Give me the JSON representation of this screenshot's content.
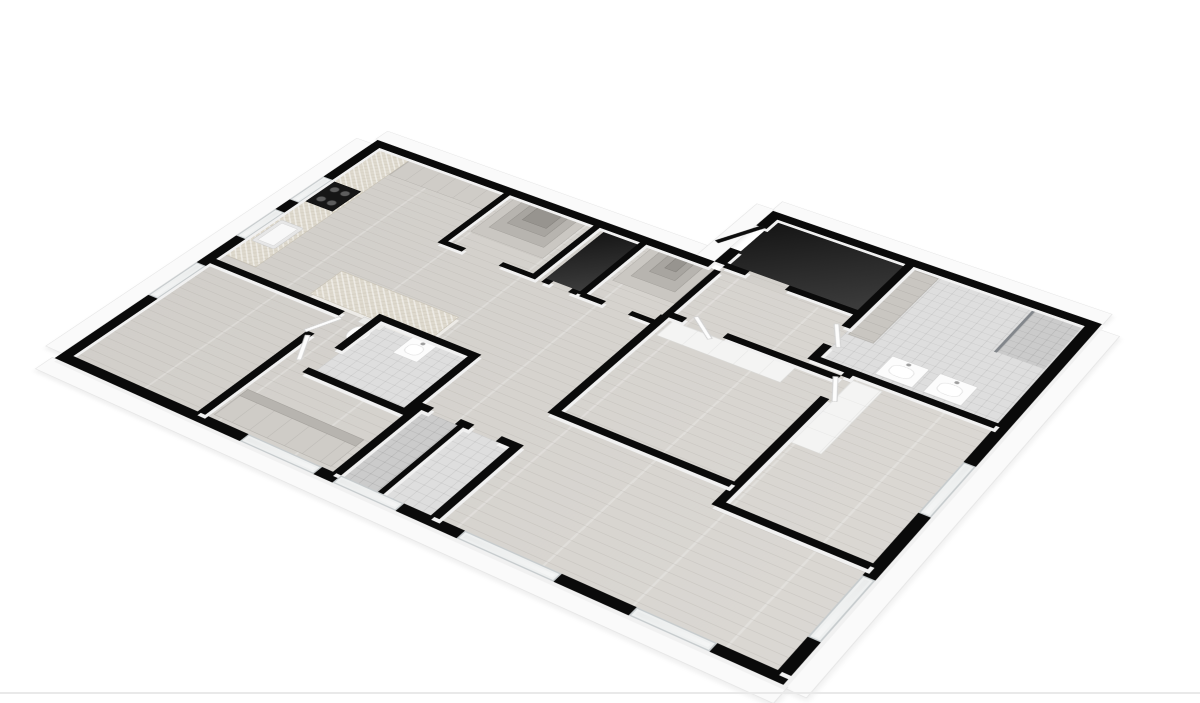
{
  "page": {
    "background": "#ffffff",
    "width": 1200,
    "height": 703
  },
  "palette": {
    "wall_cut_top": "#0a0a0a",
    "wall_face": "#f1f1f1",
    "slab_white": "#fafafa",
    "wood_floor": "#d8d5d0",
    "tile_floor": "#dedede",
    "dark_floor": "#262626",
    "cabinet_gray": "#cfccc7",
    "stone_counter": "#ded9cd",
    "shelf_gray": "#b7b4af",
    "footer_divider": "#e9e9e9"
  },
  "floorplan": {
    "rects": [
      {
        "n": "slab-west",
        "k": "fascia",
        "x": 2,
        "y": 192,
        "w": 28,
        "h": 616
      },
      {
        "n": "slab-north-kitchen",
        "k": "fascia",
        "x": 26,
        "y": 152,
        "w": 566,
        "h": 28
      },
      {
        "n": "slab-north-suite",
        "k": "fascia",
        "x": 588,
        "y": 2,
        "w": 484,
        "h": 28
      },
      {
        "n": "slab-west-suite",
        "k": "fascia",
        "x": 562,
        "y": 26,
        "w": 28,
        "h": 158
      },
      {
        "n": "slab-east",
        "k": "fascia",
        "x": 1070,
        "y": 42,
        "w": 30,
        "h": 782
      },
      {
        "n": "slab-south",
        "k": "fascia",
        "x": 26,
        "y": 820,
        "w": 1050,
        "h": 30
      },
      {
        "n": "floor-great-room",
        "k": "wood",
        "x": 46,
        "y": 196,
        "w": 1008,
        "h": 608
      },
      {
        "n": "floor-suite-wing",
        "k": "wood",
        "x": 606,
        "y": 46,
        "w": 448,
        "h": 150
      },
      {
        "n": "floor-entry-vestibule",
        "k": "dark",
        "x": 606,
        "y": 46,
        "w": 194,
        "h": 128
      },
      {
        "n": "floor-linen-closet",
        "k": "dark",
        "x": 430,
        "y": 196,
        "w": 54,
        "h": 140
      },
      {
        "n": "floor-main-bathroom",
        "k": "tile",
        "x": 812,
        "y": 46,
        "w": 242,
        "h": 244
      },
      {
        "n": "floor-shower-nook",
        "k": "tile2",
        "x": 988,
        "y": 48,
        "w": 64,
        "h": 110
      },
      {
        "n": "floor-center-bathroom",
        "k": "tile",
        "x": 314,
        "y": 532,
        "w": 136,
        "h": 128
      },
      {
        "n": "floor-shower-room-a",
        "k": "tile2",
        "x": 470,
        "y": 652,
        "w": 54,
        "h": 152
      },
      {
        "n": "floor-shower-room-b",
        "k": "tile",
        "x": 532,
        "y": 652,
        "w": 68,
        "h": 152
      },
      {
        "n": "kitchen-counter",
        "k": "stone",
        "x": 46,
        "y": 196,
        "w": 56,
        "h": 330
      },
      {
        "n": "kitchen-sink",
        "k": "sink",
        "x": 54,
        "y": 418,
        "w": 40,
        "h": 62
      },
      {
        "n": "cooktop",
        "k": "appliance",
        "x": 50,
        "y": 302,
        "w": 48,
        "h": 62
      },
      {
        "n": "kitchen-tall-cabinets",
        "k": "cabinet",
        "x": 102,
        "y": 196,
        "w": 170,
        "h": 50
      },
      {
        "n": "kitchen-island",
        "k": "island",
        "x": 200,
        "y": 470,
        "w": 190,
        "h": 64
      },
      {
        "n": "pantry-shelf-outer",
        "k": "shelf1",
        "x": 282,
        "y": 196,
        "w": 118,
        "h": 104
      },
      {
        "n": "pantry-shelf-mid",
        "k": "shelf2",
        "x": 296,
        "y": 196,
        "w": 90,
        "h": 82
      },
      {
        "n": "pantry-shelf-inner",
        "k": "shelf3",
        "x": 310,
        "y": 196,
        "w": 62,
        "h": 60
      },
      {
        "n": "pantry-shelf-core",
        "k": "shelf4",
        "x": 322,
        "y": 196,
        "w": 40,
        "h": 42
      },
      {
        "n": "walkin-closet-shelf-outer",
        "k": "shelf1",
        "x": 504,
        "y": 196,
        "w": 96,
        "h": 96
      },
      {
        "n": "walkin-closet-shelf-mid",
        "k": "shelf2",
        "x": 518,
        "y": 196,
        "w": 68,
        "h": 74
      },
      {
        "n": "walkin-closet-shelf-inner",
        "k": "shelf3",
        "x": 532,
        "y": 196,
        "w": 40,
        "h": 52
      },
      {
        "n": "walkin-closet-shelf-core",
        "k": "shelf4",
        "x": 544,
        "y": 196,
        "w": 18,
        "h": 34
      },
      {
        "n": "bathroom-wardrobe",
        "k": "cabinet-v",
        "x": 816,
        "y": 52,
        "w": 36,
        "h": 176
      },
      {
        "n": "vanity-basin-1",
        "k": "vanity",
        "x": 884,
        "y": 238,
        "w": 52,
        "h": 46
      },
      {
        "n": "vanity-basin-2",
        "k": "vanity",
        "x": 950,
        "y": 238,
        "w": 52,
        "h": 46
      },
      {
        "n": "shower-glass",
        "k": "glass",
        "x": 984,
        "y": 48,
        "w": 4,
        "h": 112
      },
      {
        "n": "toilet-tank",
        "k": "fixture",
        "x": 290,
        "y": 536,
        "w": 36,
        "h": 14
      },
      {
        "n": "toilet-bowl",
        "k": "toilet",
        "x": 294,
        "y": 552,
        "w": 28,
        "h": 36
      },
      {
        "n": "centerbath-vanity",
        "k": "vanity",
        "x": 368,
        "y": 536,
        "w": 38,
        "h": 42
      },
      {
        "n": "bedroom1-closet",
        "k": "closet",
        "x": 868,
        "y": 310,
        "w": 42,
        "h": 150
      },
      {
        "n": "bedroom2-closet",
        "k": "closet",
        "x": 618,
        "y": 326,
        "w": 180,
        "h": 38
      },
      {
        "n": "wardrobe-shelving",
        "k": "cabinet",
        "x": 270,
        "y": 736,
        "w": 180,
        "h": 62
      },
      {
        "n": "wardrobe-shelf-band",
        "k": "shelf2",
        "x": 270,
        "y": 736,
        "w": 180,
        "h": 16
      },
      {
        "n": "wall-north",
        "k": "wall",
        "x": 30,
        "y": 180,
        "w": 560,
        "h": 16
      },
      {
        "n": "wall-suite-north",
        "k": "wall",
        "x": 590,
        "y": 30,
        "w": 480,
        "h": 16
      },
      {
        "n": "wall-suite-west-a",
        "k": "wall",
        "x": 590,
        "y": 46,
        "w": 16,
        "h": 28
      },
      {
        "n": "wall-suite-west-b",
        "k": "wall",
        "x": 590,
        "y": 140,
        "w": 16,
        "h": 40
      },
      {
        "n": "wall-west",
        "k": "wall",
        "x": 30,
        "y": 196,
        "w": 16,
        "h": 608
      },
      {
        "n": "wall-south",
        "k": "wall",
        "x": 30,
        "y": 804,
        "w": 1040,
        "h": 16
      },
      {
        "n": "wall-east",
        "k": "wall",
        "x": 1054,
        "y": 46,
        "w": 16,
        "h": 758
      },
      {
        "n": "wall-vestibule-a",
        "k": "wall",
        "x": 606,
        "y": 174,
        "w": 34,
        "h": 12
      },
      {
        "n": "wall-vestibule-b",
        "k": "wall",
        "x": 700,
        "y": 174,
        "w": 106,
        "h": 12
      },
      {
        "n": "wall-pantry-west",
        "k": "wall",
        "x": 262,
        "y": 196,
        "w": 10,
        "h": 150
      },
      {
        "n": "wall-pantry-east",
        "k": "wall",
        "x": 410,
        "y": 196,
        "w": 10,
        "h": 150
      },
      {
        "n": "wall-pantry-south-a",
        "k": "wall",
        "x": 262,
        "y": 336,
        "w": 40,
        "h": 10
      },
      {
        "n": "wall-pantry-south-b",
        "k": "wall",
        "x": 362,
        "y": 336,
        "w": 58,
        "h": 10
      },
      {
        "n": "wall-linen-east",
        "k": "wall",
        "x": 484,
        "y": 196,
        "w": 10,
        "h": 150
      },
      {
        "n": "wall-linen-south-a",
        "k": "wall",
        "x": 430,
        "y": 336,
        "w": 12,
        "h": 10
      },
      {
        "n": "wall-linen-south-b",
        "k": "wall",
        "x": 472,
        "y": 336,
        "w": 12,
        "h": 10
      },
      {
        "n": "wall-closet-east",
        "k": "wall",
        "x": 600,
        "y": 196,
        "w": 10,
        "h": 150
      },
      {
        "n": "wall-closet-south-a",
        "k": "wall",
        "x": 494,
        "y": 336,
        "w": 30,
        "h": 10
      },
      {
        "n": "wall-closet-south-b",
        "k": "wall",
        "x": 564,
        "y": 336,
        "w": 46,
        "h": 10
      },
      {
        "n": "wall-bedroom2-north-a",
        "k": "wall",
        "x": 610,
        "y": 310,
        "w": 20,
        "h": 12
      },
      {
        "n": "wall-bedroom2-north-b",
        "k": "wall",
        "x": 690,
        "y": 310,
        "w": 162,
        "h": 12
      },
      {
        "n": "wall-bathroom-west-a",
        "k": "wall",
        "x": 800,
        "y": 46,
        "w": 12,
        "h": 170
      },
      {
        "n": "wall-bathroom-west-b",
        "k": "wall",
        "x": 800,
        "y": 262,
        "w": 12,
        "h": 40
      },
      {
        "n": "wall-bathroom-south",
        "k": "wall",
        "x": 800,
        "y": 290,
        "w": 254,
        "h": 12
      },
      {
        "n": "wall-bedroom1-west-a",
        "k": "wall",
        "x": 852,
        "y": 302,
        "w": 12,
        "h": 8
      },
      {
        "n": "wall-bedroom1-west-b",
        "k": "wall",
        "x": 852,
        "y": 360,
        "w": 12,
        "h": 250
      },
      {
        "n": "wall-bedroom1-south",
        "k": "wall",
        "x": 852,
        "y": 598,
        "w": 202,
        "h": 12
      },
      {
        "n": "wall-bedroom2-west",
        "k": "wall",
        "x": 598,
        "y": 322,
        "w": 12,
        "h": 250
      },
      {
        "n": "wall-bedroom2-south",
        "k": "wall",
        "x": 598,
        "y": 560,
        "w": 254,
        "h": 12
      },
      {
        "n": "wall-bedroom3-north",
        "k": "wall",
        "x": 46,
        "y": 540,
        "w": 216,
        "h": 12
      },
      {
        "n": "wall-bedroom3-east-a",
        "k": "wall",
        "x": 250,
        "y": 540,
        "w": 12,
        "h": 12
      },
      {
        "n": "wall-bedroom3-east-b",
        "k": "wall",
        "x": 250,
        "y": 600,
        "w": 12,
        "h": 204
      },
      {
        "n": "wall-centerbath-north",
        "k": "wall",
        "x": 302,
        "y": 520,
        "w": 160,
        "h": 12
      },
      {
        "n": "wall-centerbath-west",
        "k": "wall",
        "x": 302,
        "y": 532,
        "w": 12,
        "h": 78
      },
      {
        "n": "wall-centerbath-south",
        "k": "wall",
        "x": 302,
        "y": 660,
        "w": 160,
        "h": 12
      },
      {
        "n": "wall-centerbath-east",
        "k": "wall",
        "x": 450,
        "y": 520,
        "w": 12,
        "h": 152
      },
      {
        "n": "wall-showers-north-a",
        "k": "wall",
        "x": 458,
        "y": 640,
        "w": 22,
        "h": 12
      },
      {
        "n": "wall-showers-north-b",
        "k": "wall",
        "x": 520,
        "y": 640,
        "w": 20,
        "h": 12
      },
      {
        "n": "wall-showers-north-c",
        "k": "wall",
        "x": 580,
        "y": 640,
        "w": 32,
        "h": 12
      },
      {
        "n": "wall-showers-west",
        "k": "wall",
        "x": 458,
        "y": 652,
        "w": 12,
        "h": 152
      },
      {
        "n": "wall-showers-divider",
        "k": "wall",
        "x": 524,
        "y": 652,
        "w": 8,
        "h": 152
      },
      {
        "n": "wall-showers-east",
        "k": "wall",
        "x": 600,
        "y": 652,
        "w": 12,
        "h": 152
      },
      {
        "n": "window-kitchen-1",
        "k": "window",
        "x": 30,
        "y": 300,
        "w": 16,
        "h": 72
      },
      {
        "n": "window-kitchen-2",
        "k": "window",
        "x": 30,
        "y": 402,
        "w": 16,
        "h": 80
      },
      {
        "n": "window-bedroom3",
        "k": "window",
        "x": 30,
        "y": 560,
        "w": 16,
        "h": 92
      },
      {
        "n": "window-south-1",
        "k": "window",
        "x": 330,
        "y": 804,
        "w": 112,
        "h": 16
      },
      {
        "n": "window-south-2",
        "k": "window",
        "x": 470,
        "y": 804,
        "w": 92,
        "h": 16
      },
      {
        "n": "window-living-1",
        "k": "window",
        "x": 648,
        "y": 804,
        "w": 132,
        "h": 16
      },
      {
        "n": "window-living-2",
        "k": "window",
        "x": 878,
        "y": 804,
        "w": 102,
        "h": 16
      },
      {
        "n": "window-bedroom1",
        "k": "window",
        "x": 1054,
        "y": 380,
        "w": 16,
        "h": 112
      },
      {
        "n": "window-living-east",
        "k": "window",
        "x": 1054,
        "y": 622,
        "w": 16,
        "h": 120
      },
      {
        "n": "entry-door",
        "k": "door-dark",
        "x": 580,
        "y": 66,
        "w": 8,
        "h": 76,
        "r": 26
      },
      {
        "n": "bedroom2-door",
        "k": "door",
        "x": 632,
        "y": 314,
        "w": 52,
        "h": 7,
        "r": 38
      },
      {
        "n": "centerbath-door",
        "k": "door",
        "x": 266,
        "y": 604,
        "w": 7,
        "h": 54,
        "r": -28
      },
      {
        "n": "bedroom3-door",
        "k": "door",
        "x": 254,
        "y": 552,
        "w": 7,
        "h": 52,
        "r": 22
      },
      {
        "n": "bathroom-door",
        "k": "door",
        "x": 803,
        "y": 212,
        "w": 7,
        "h": 52,
        "r": -32
      },
      {
        "n": "bedroom1-door",
        "k": "door",
        "x": 856,
        "y": 312,
        "w": 7,
        "h": 52,
        "r": -28
      }
    ]
  },
  "screen": {
    "rects": [
      {
        "n": "footer-divider",
        "k": "divider",
        "x": 0,
        "y": 692,
        "w": 1200,
        "h": 2
      }
    ]
  }
}
